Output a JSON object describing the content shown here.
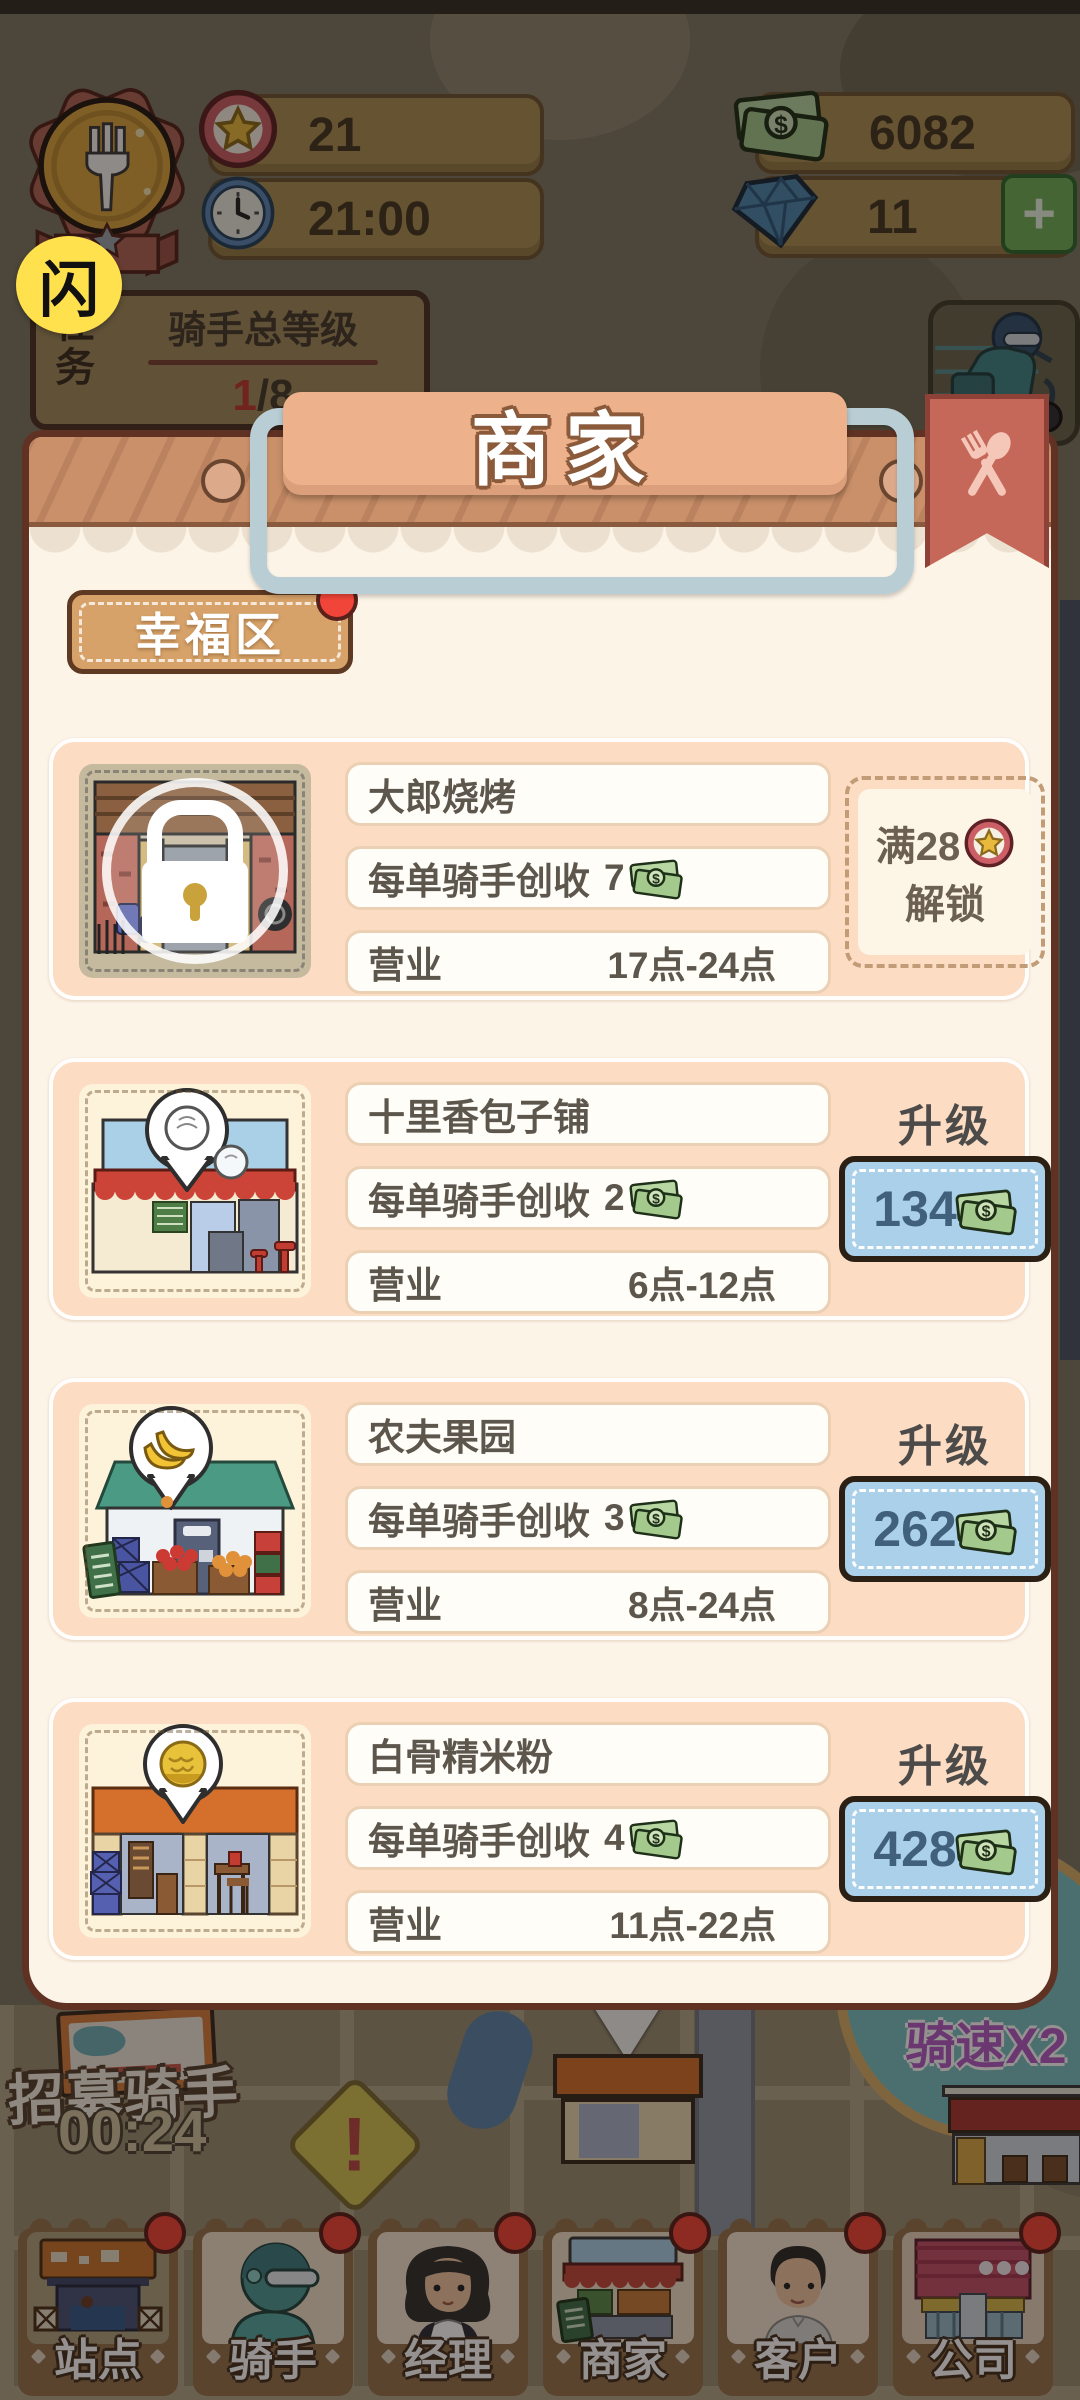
{
  "hud": {
    "stars": "21",
    "time": "21:00",
    "money": "6082",
    "diamonds": "11",
    "plus_label": "+",
    "flash_badge": "闪",
    "task": {
      "side_label": "任务",
      "title": "骑手总等级",
      "current": "1",
      "total": "/8"
    }
  },
  "modal": {
    "title": "商家",
    "district_tab": "幸福区",
    "merchants": [
      {
        "name": "大郎烧烤",
        "income": "7",
        "hours": "17点-24点",
        "locked": true,
        "unlock_prefix": "满28",
        "unlock_action": "解锁"
      },
      {
        "name": "十里香包子铺",
        "income": "2",
        "hours": "6点-12点",
        "upgrade_cost": "134"
      },
      {
        "name": "农夫果园",
        "income": "3",
        "hours": "8点-24点",
        "upgrade_cost": "262"
      },
      {
        "name": "白骨精米粉",
        "income": "4",
        "hours": "11点-22点",
        "upgrade_cost": "428"
      }
    ]
  },
  "labels": {
    "income_label": "每单骑手创收",
    "hours_label": "营业",
    "upgrade_label": "升级"
  },
  "map": {
    "recruit_label": "招募骑手",
    "recruit_timer": "00:24",
    "warning_mark": "!",
    "speed_line1": "长按",
    "speed_line2": "骑速X2"
  },
  "nav": {
    "items": [
      {
        "label": "站点"
      },
      {
        "label": "骑手"
      },
      {
        "label": "经理"
      },
      {
        "label": "商家"
      },
      {
        "label": "客户"
      },
      {
        "label": "公司"
      }
    ]
  },
  "colors": {
    "upgrade_button_bg": "#abd0e9",
    "notification_red": "#f2453a",
    "gold_coin": "#d9a53e",
    "modal_bg": "#fdf4e8",
    "card_bg": "#fcdcc3"
  }
}
